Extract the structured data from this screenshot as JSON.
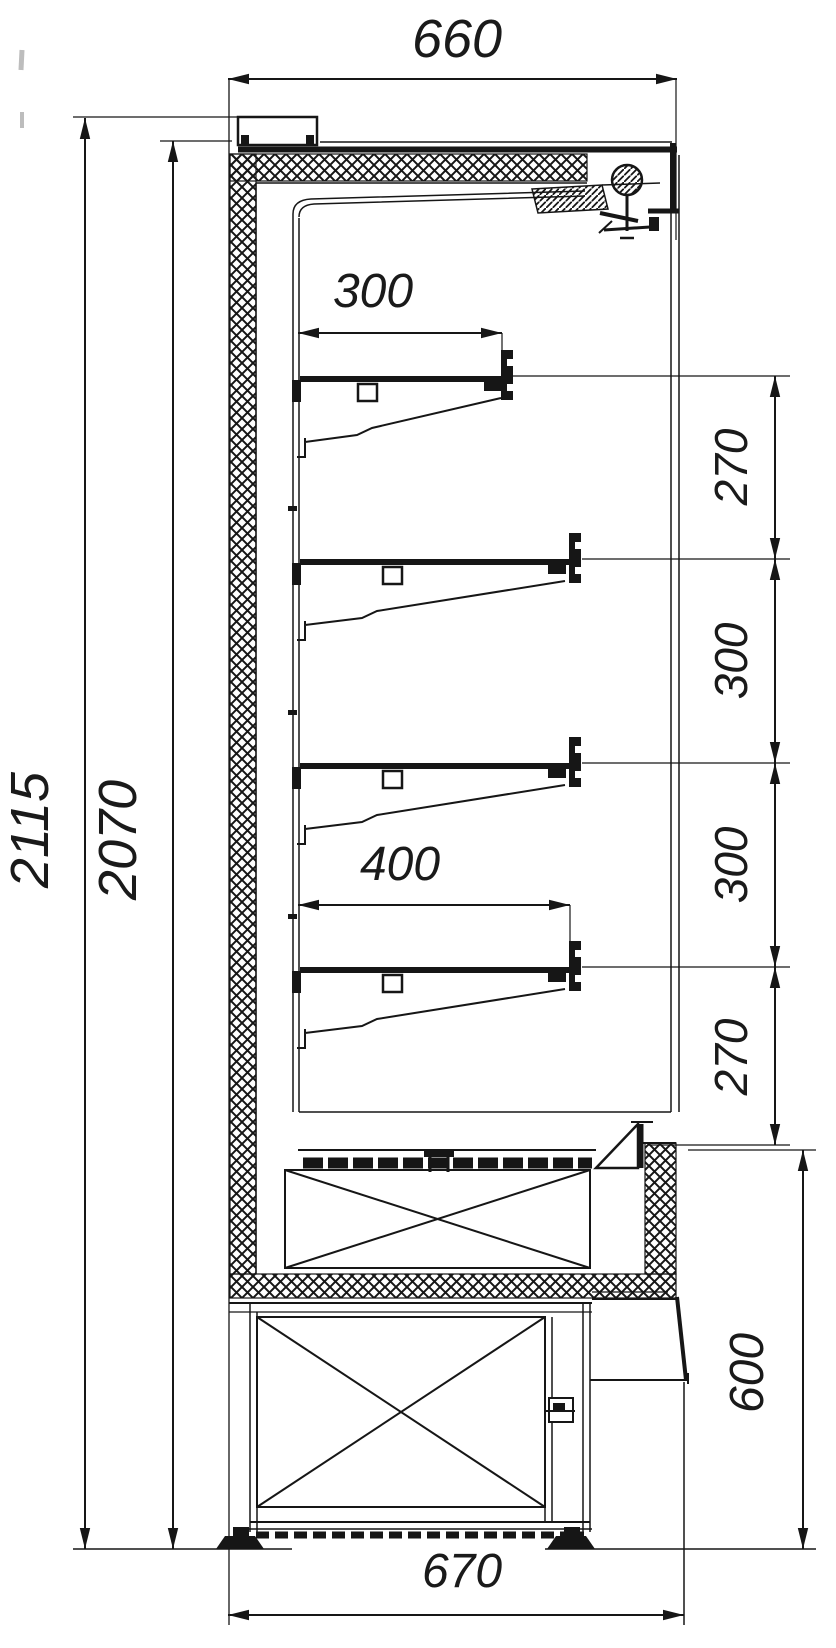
{
  "page": {
    "background": "#ffffff",
    "line_color": "#161616",
    "text_color": "#1a1a1a"
  },
  "drawing": {
    "type": "refrigerated-display-cabinet-cross-section",
    "dimensions": {
      "top_width": "660",
      "overall_height": "2115",
      "interior_height": "2070",
      "top_shelf_depth": "300",
      "lower_shelf_depth": "400",
      "shelf_spacing": [
        "270",
        "300",
        "300",
        "270"
      ],
      "base_height": "600",
      "bottom_width": "670"
    }
  }
}
